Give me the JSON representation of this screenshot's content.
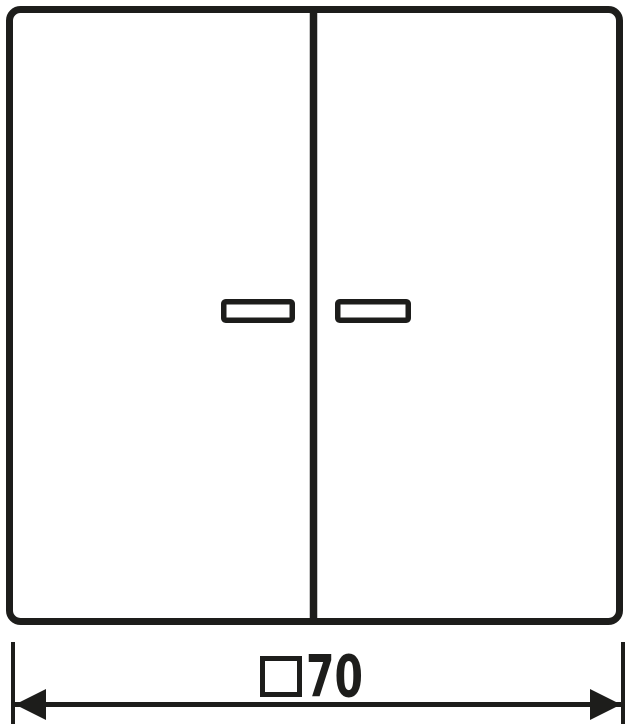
{
  "dimension": {
    "label": "□70",
    "symbol": "□",
    "symbol_name": "square-dimension-symbol",
    "value": "70"
  },
  "colors": {
    "line": "#1d1d1b",
    "background": "#ffffff"
  }
}
